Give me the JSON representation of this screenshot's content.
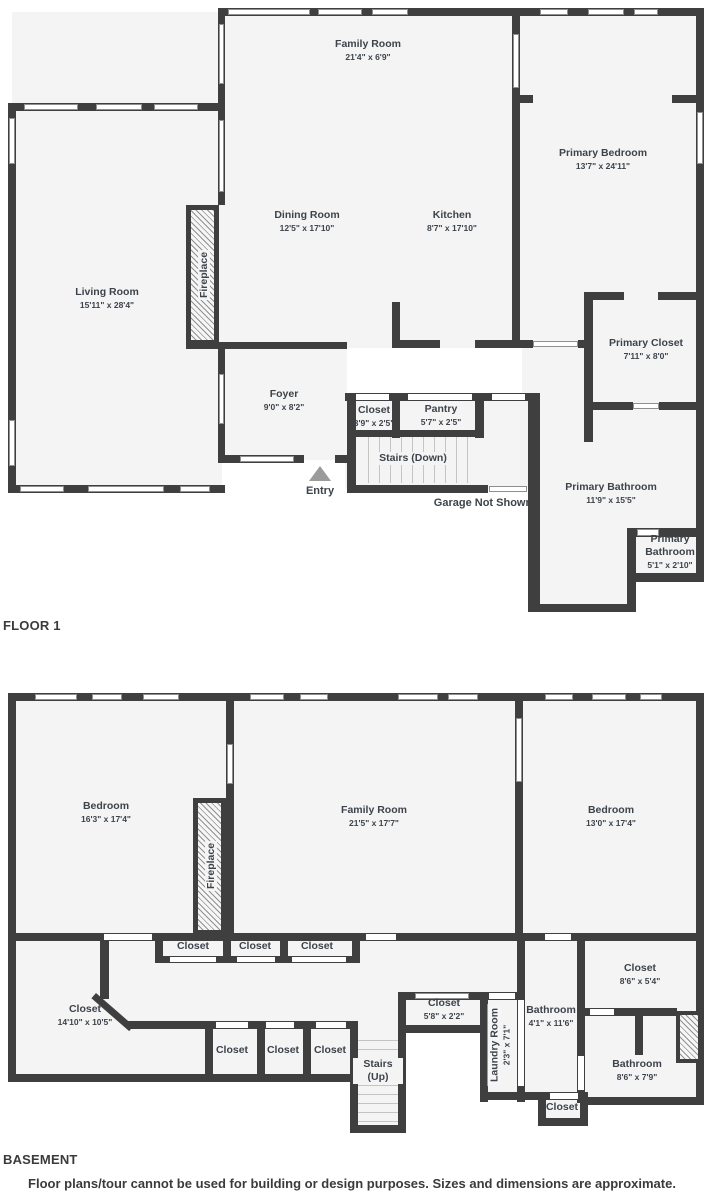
{
  "floor1": {
    "section_label": "FLOOR 1",
    "fireplace_label": "Fireplace",
    "entry_label": "Entry",
    "garage_note": "Garage Not Shown",
    "rooms": [
      {
        "name": "Family Room",
        "dims": "21'4\" x 6'9\""
      },
      {
        "name": "Dining Room",
        "dims": "12'5\" x 17'10\""
      },
      {
        "name": "Kitchen",
        "dims": "8'7\" x 17'10\""
      },
      {
        "name": "Living Room",
        "dims": "15'11\" x 28'4\""
      },
      {
        "name": "Primary Bedroom",
        "dims": "13'7\" x 24'11\""
      },
      {
        "name": "Primary Closet",
        "dims": "7'11\" x 8'0\""
      },
      {
        "name": "Foyer",
        "dims": "9'0\" x 8'2\""
      },
      {
        "name": "Closet",
        "dims": "3'9\" x 2'5\""
      },
      {
        "name": "Pantry",
        "dims": "5'7\" x 2'5\""
      },
      {
        "name": "Stairs (Down)",
        "dims": ""
      },
      {
        "name": "Primary Bathroom",
        "dims": "11'9\" x 15'5\""
      },
      {
        "name": "Primary Bathroom",
        "dims": "5'1\" x 2'10\""
      }
    ]
  },
  "basement": {
    "section_label": "BASEMENT",
    "fireplace_label": "Fireplace",
    "rooms": [
      {
        "name": "Bedroom",
        "dims": "16'3\" x 17'4\""
      },
      {
        "name": "Family Room",
        "dims": "21'5\" x 17'7\""
      },
      {
        "name": "Bedroom",
        "dims": "13'0\" x 17'4\""
      },
      {
        "name": "Closet",
        "dims": ""
      },
      {
        "name": "Closet",
        "dims": ""
      },
      {
        "name": "Closet",
        "dims": ""
      },
      {
        "name": "Closet",
        "dims": "14'10\" x 10'5\""
      },
      {
        "name": "Closet",
        "dims": ""
      },
      {
        "name": "Closet",
        "dims": ""
      },
      {
        "name": "Closet",
        "dims": ""
      },
      {
        "name": "Stairs (Up)",
        "dims": ""
      },
      {
        "name": "Closet",
        "dims": "5'8\" x 2'2\""
      },
      {
        "name": "Laundry Room",
        "dims": "2'3\" x 7'1\""
      },
      {
        "name": "Bathroom",
        "dims": "4'1\" x 11'6\""
      },
      {
        "name": "Closet",
        "dims": "8'6\" x 5'4\""
      },
      {
        "name": "Bathroom",
        "dims": "8'6\" x 7'9\""
      },
      {
        "name": "Closet",
        "dims": ""
      }
    ]
  },
  "footer": {
    "disclaimer": "Floor plans/tour cannot be used for building or design purposes. Sizes and dimensions are approximate."
  },
  "colors": {
    "wall": "#3f3f3f",
    "room_fill": "#f4f4f4",
    "text": "#3d434b"
  }
}
